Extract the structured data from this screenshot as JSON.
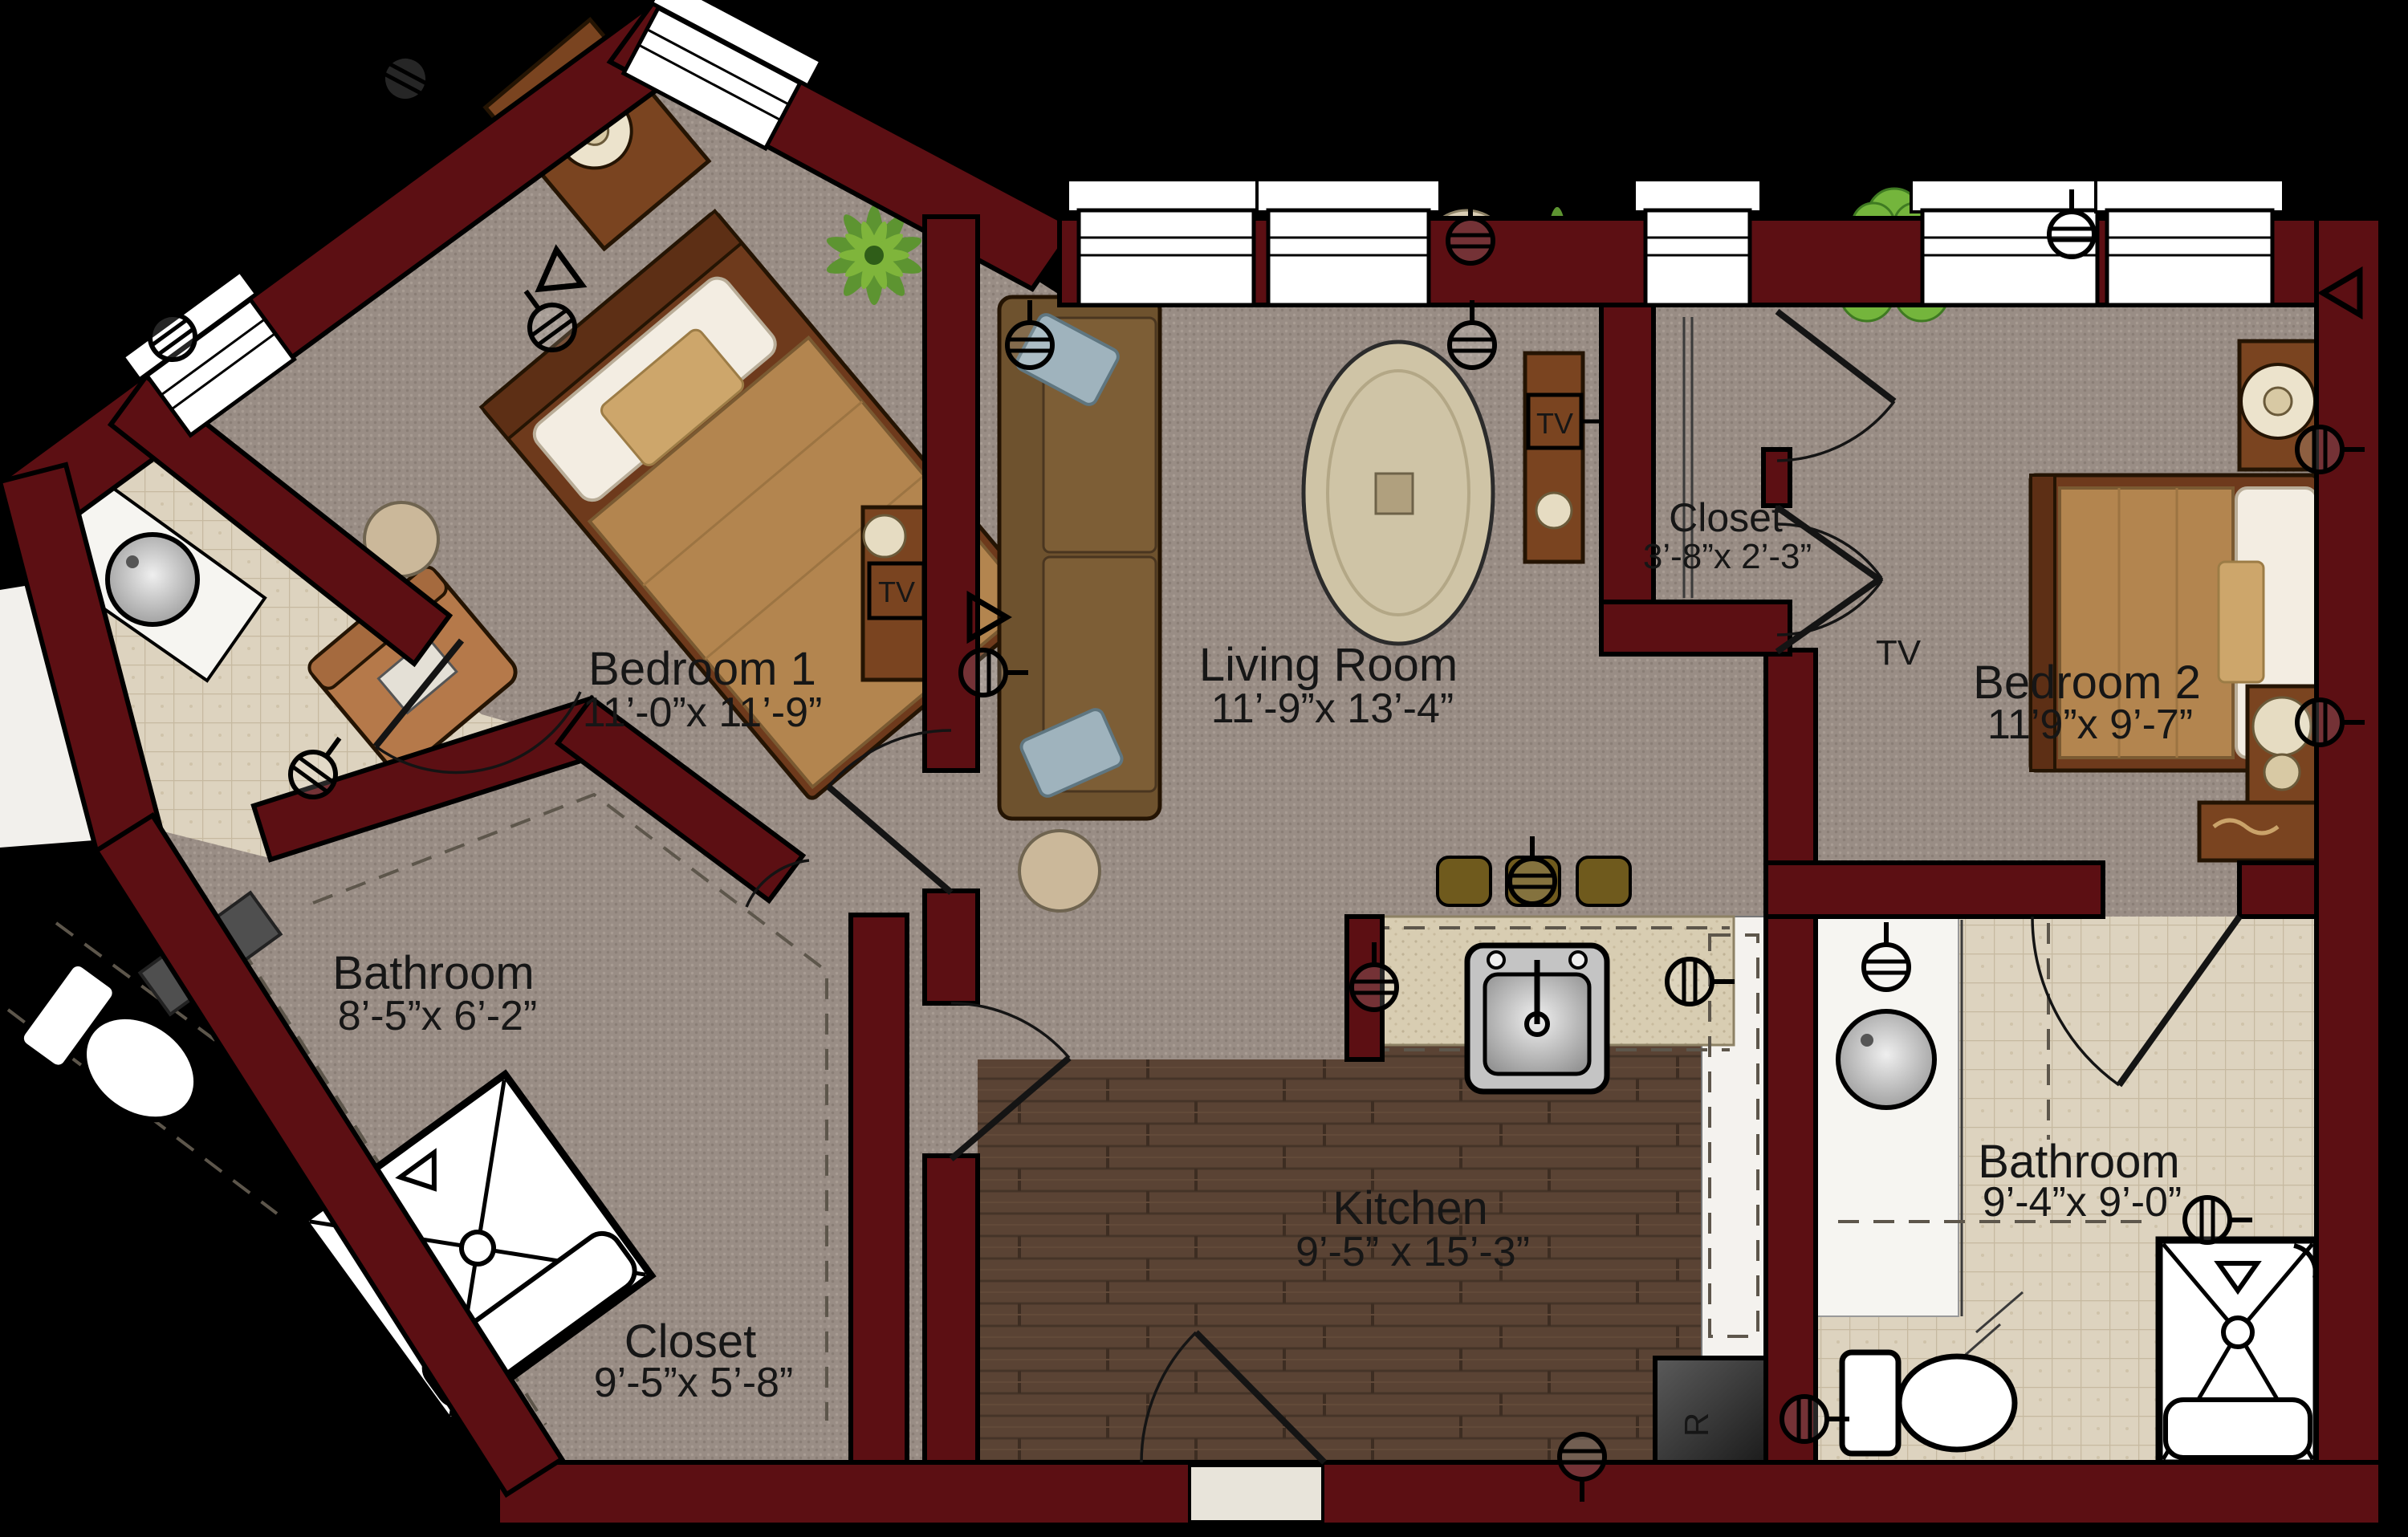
{
  "plan": {
    "title": "Two-bedroom apartment floor plan",
    "background": "#000000",
    "colors": {
      "wall": "#5c0f13",
      "carpet": "#998d85",
      "wood_floor": "#5a4334",
      "tile_floor": "#ddd3bf",
      "counter": "#d8cdb2",
      "fixture_white": "#ffffff",
      "bed_spread": "#b3854f",
      "sofa": "#7a5c36",
      "plant_green": "#5d9431",
      "accent_pillow": "#9fb3bd"
    },
    "rooms": [
      {
        "id": "bedroom-1",
        "name": "Bedroom 1",
        "dims": "11’-0”x 11’-9”"
      },
      {
        "id": "living-room",
        "name": "Living Room",
        "dims": "11’-9”x 13’-4”"
      },
      {
        "id": "closet-top",
        "name": "Closet",
        "dims": "3’-8”x 2’-3”"
      },
      {
        "id": "bedroom-2",
        "name": "Bedroom 2",
        "dims": "11’9”x 9’-7”"
      },
      {
        "id": "bathroom-1",
        "name": "Bathroom",
        "dims": "8’-5”x 6’-2”"
      },
      {
        "id": "closet-bottom",
        "name": "Closet",
        "dims": "9’-5”x 5’-8”"
      },
      {
        "id": "kitchen",
        "name": "Kitchen",
        "dims": "9’-5” x 15’-3”"
      },
      {
        "id": "bathroom-2",
        "name": "Bathroom",
        "dims": "9’-4”x 9’-0”"
      }
    ],
    "labels": {
      "tv": "TV",
      "refrigerator": "R"
    }
  }
}
